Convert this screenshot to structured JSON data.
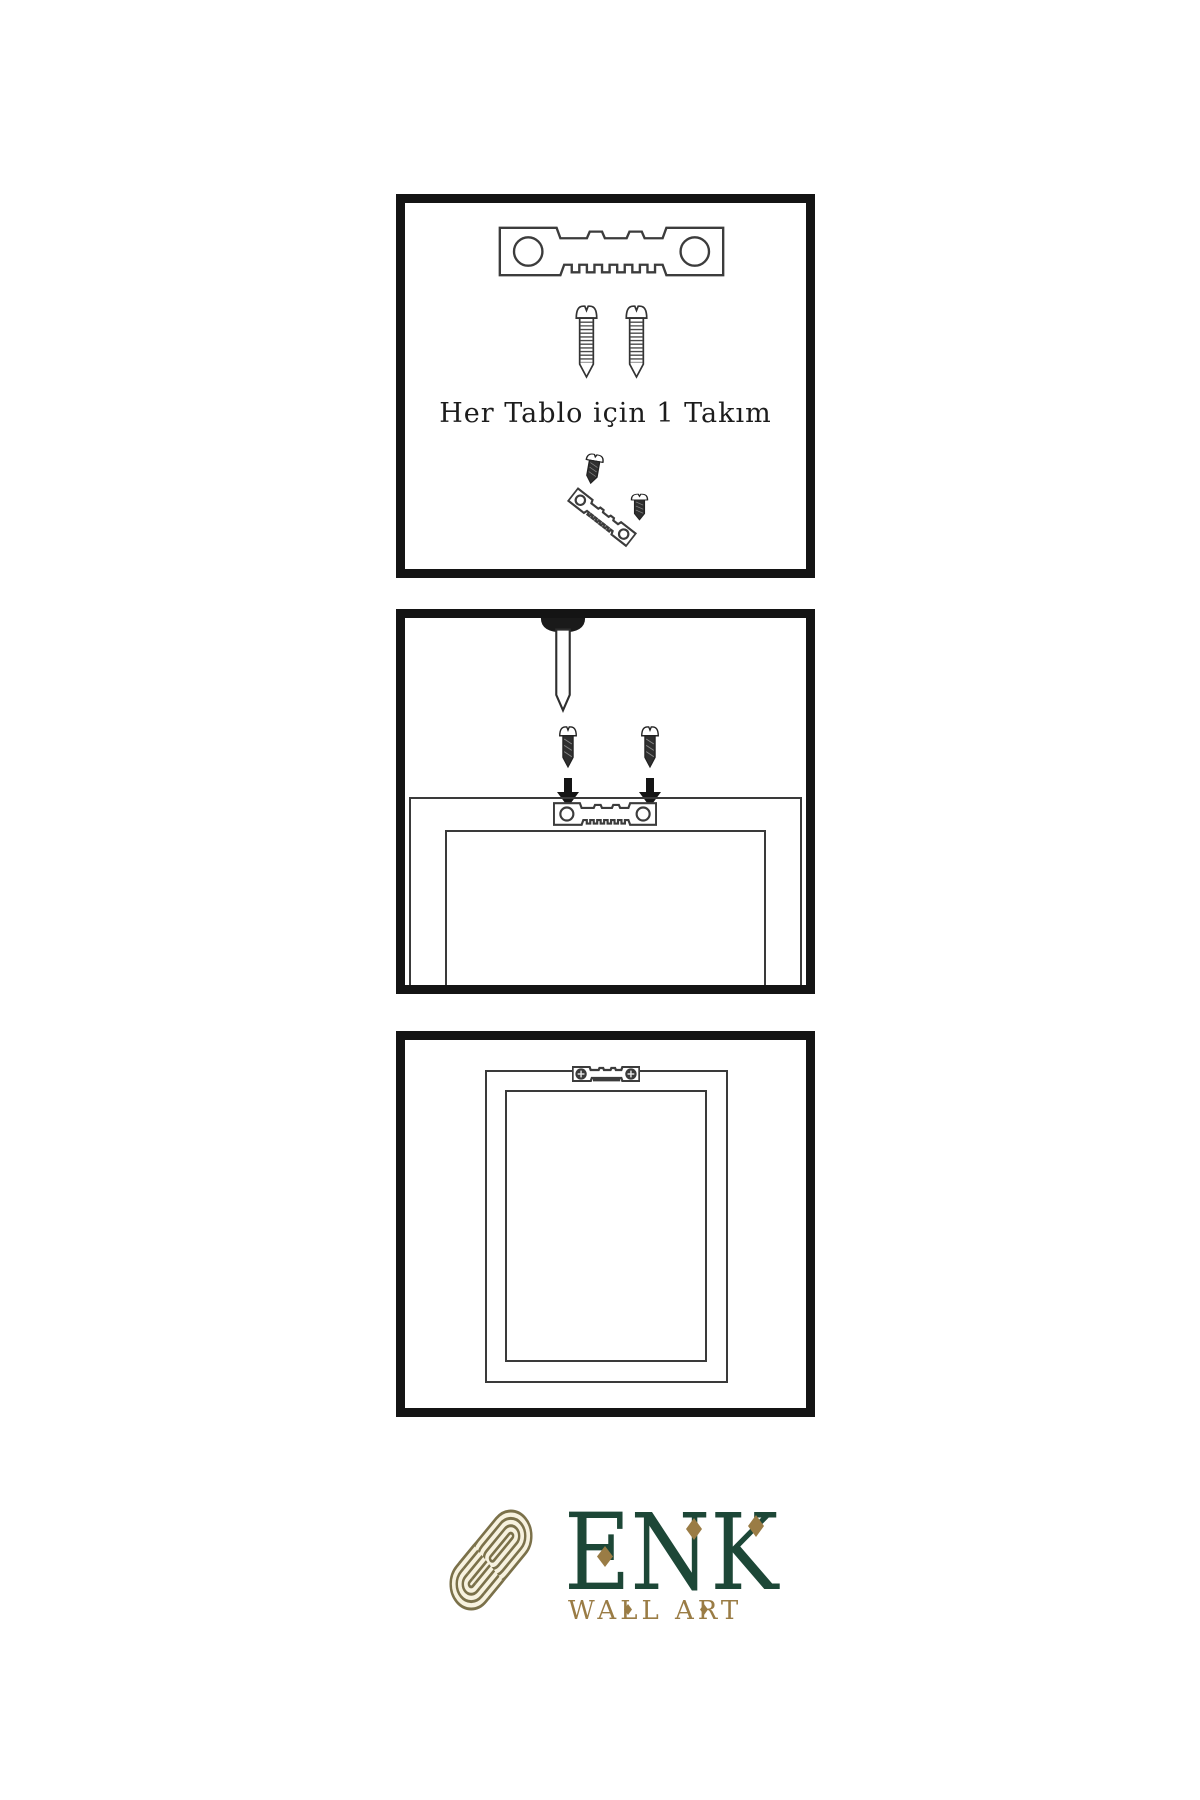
{
  "brand": {
    "name": "ENK",
    "subtitle": "WALL ART",
    "colors": {
      "green": "#1d4737",
      "gold": "#9a7c45",
      "knot_olive": "#7b714a",
      "knot_cream": "#f7f2df"
    }
  },
  "panels": {
    "kit": {
      "caption": "Her Tablo için 1 Takım",
      "icons": [
        "sawtooth-hanger-icon",
        "screw-icon",
        "screw-icon",
        "screw-icon",
        "tilted-sawtooth-hanger-icon"
      ]
    },
    "mounting": {
      "icons": [
        "nail-icon",
        "screw-icon",
        "screw-icon",
        "arrow-down-icon",
        "arrow-down-icon",
        "sawtooth-hanger-icon",
        "picture-frame-back"
      ]
    },
    "hung": {
      "icons": [
        "picture-frame-back",
        "mounted-sawtooth-hanger-icon"
      ]
    }
  },
  "drawing": {
    "line_color": "#3a3a3a",
    "panel_border_color": "#141414"
  }
}
